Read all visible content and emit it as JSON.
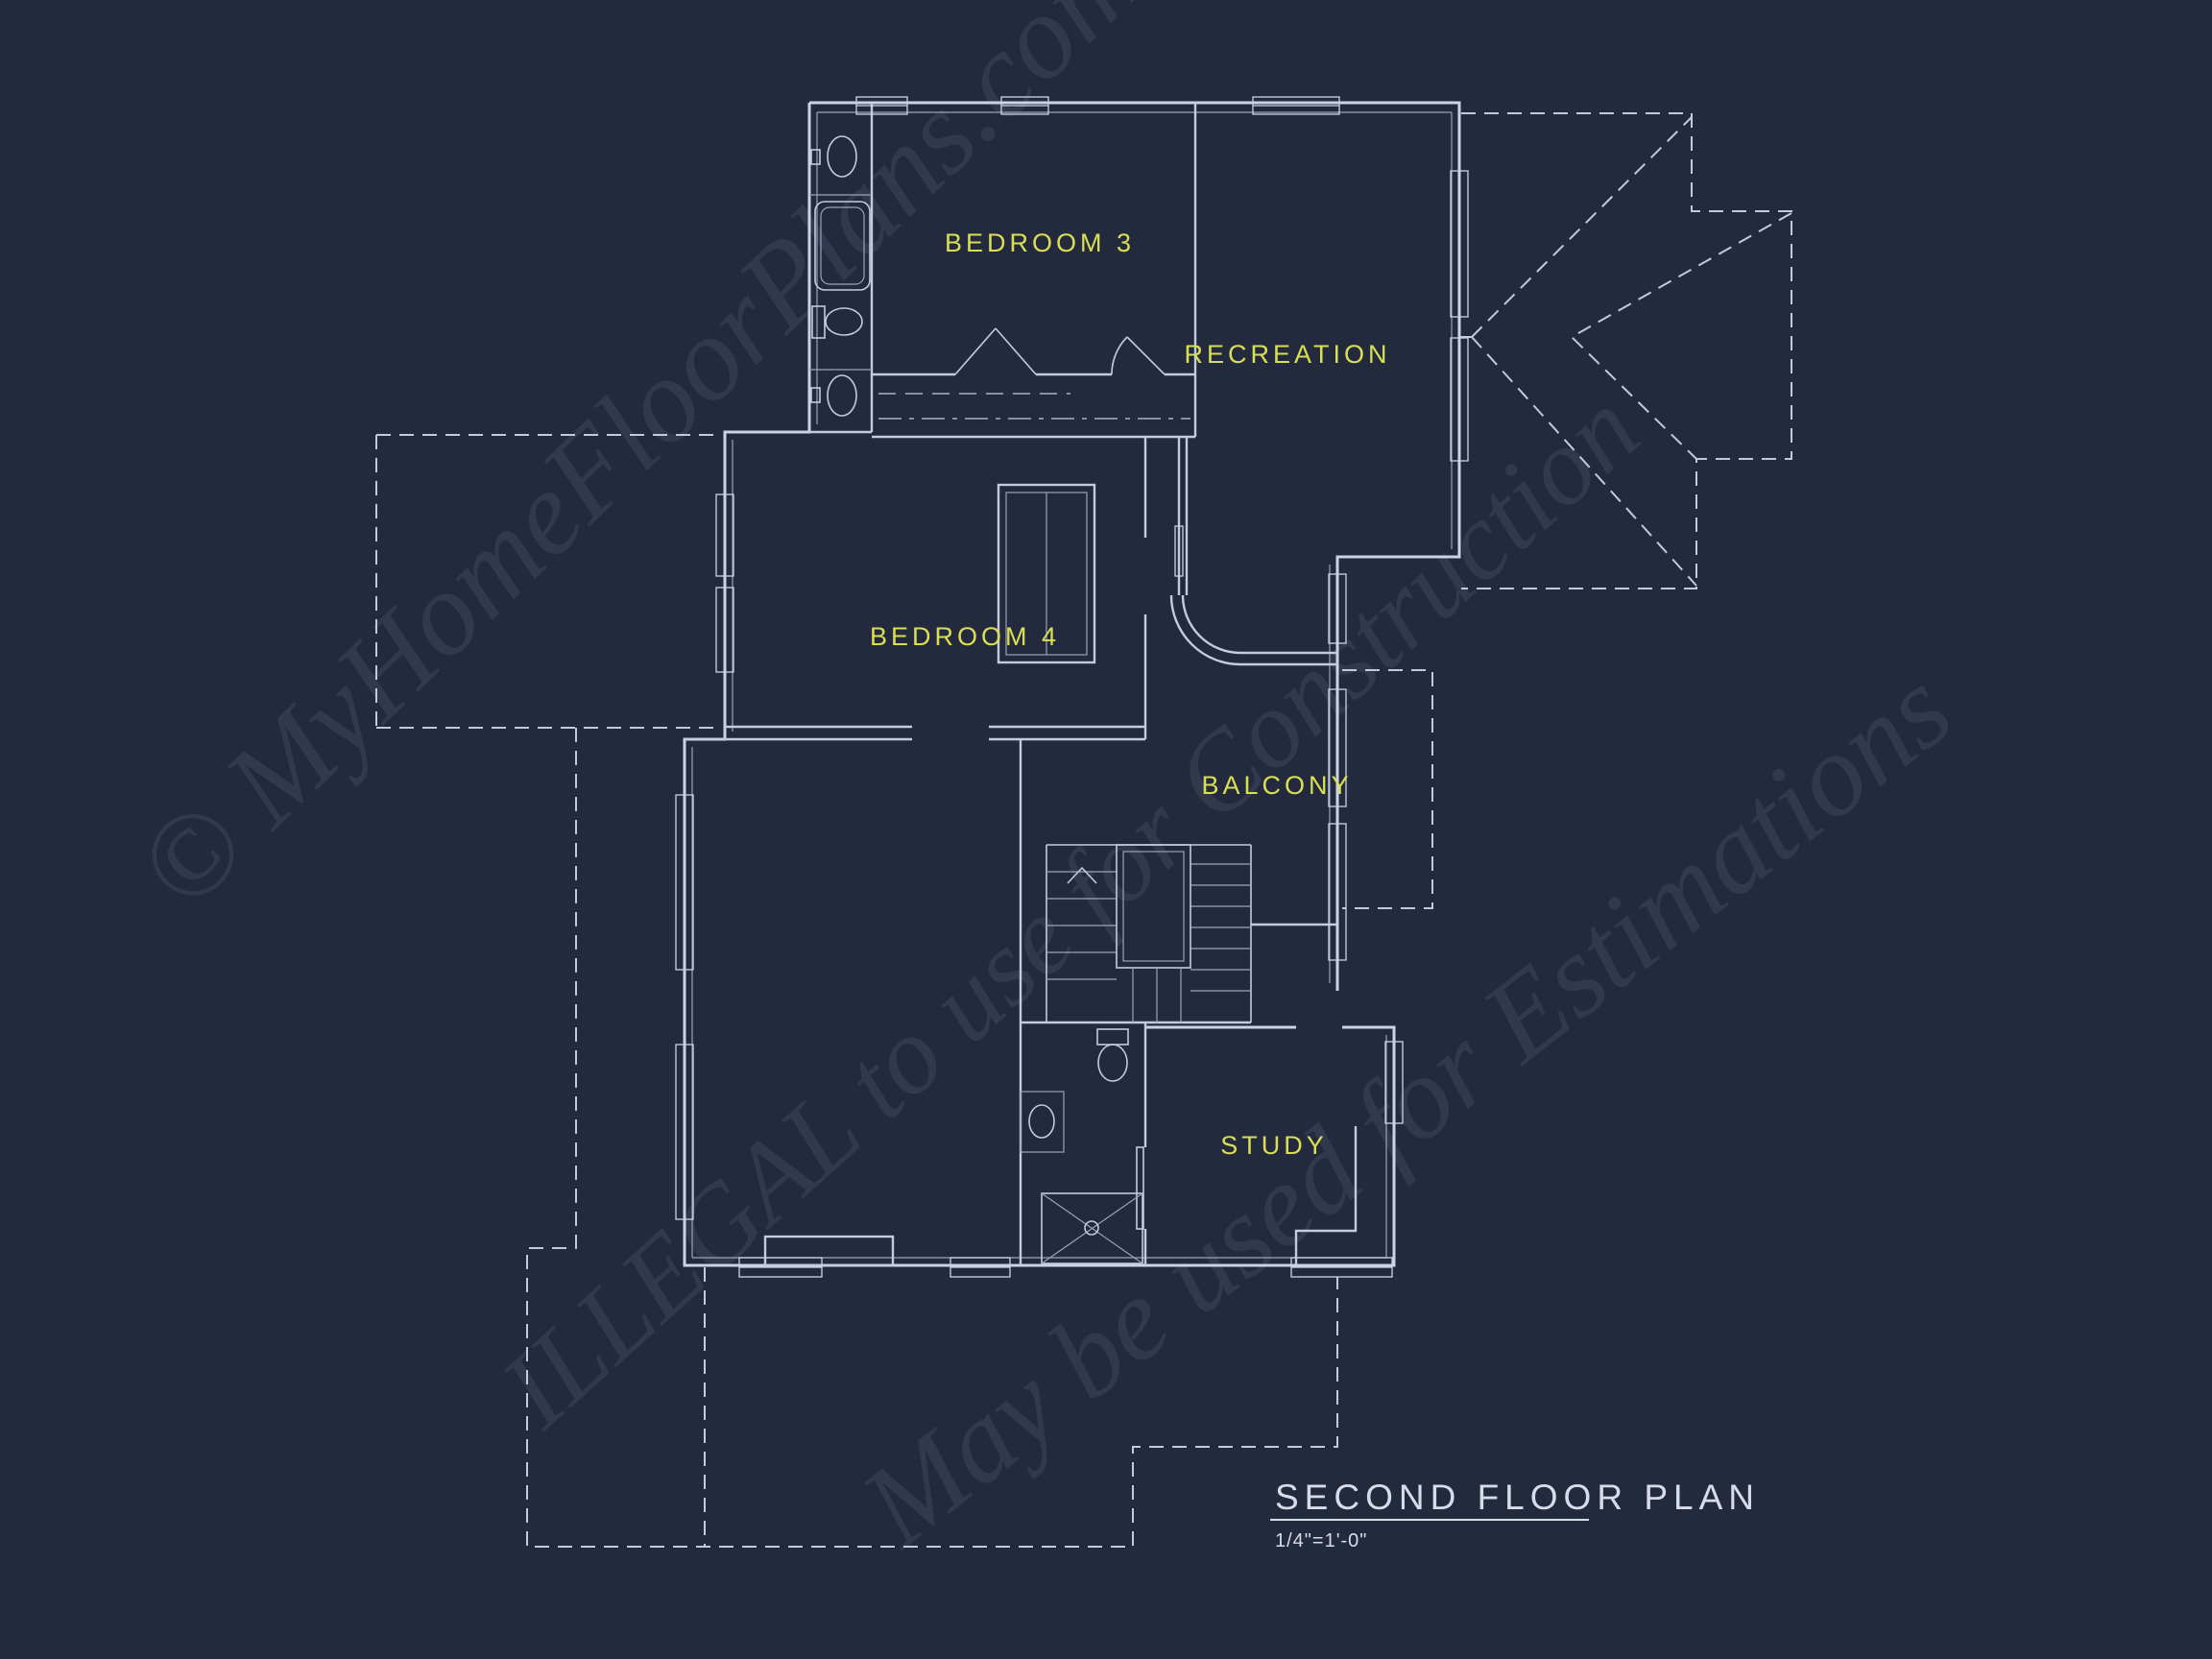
{
  "colors": {
    "background": "#242a3e",
    "wall_line": "#ccd3e6",
    "dim_line": "#9aa2bd",
    "dashed_roof_line": "#c3cade",
    "room_label": "#d9df52",
    "title_text": "#d6dcea",
    "watermark": "#cdd5f0"
  },
  "rooms": [
    {
      "id": "bedroom-3",
      "label": "BEDROOM 3"
    },
    {
      "id": "recreation",
      "label": "RECREATION"
    },
    {
      "id": "bedroom-4",
      "label": "BEDROOM 4"
    },
    {
      "id": "balcony",
      "label": "BALCONY"
    },
    {
      "id": "study",
      "label": "STUDY"
    }
  ],
  "watermark": {
    "line1": "© MyHomeFloorPlans.com",
    "line2": "ILLEGAL to use for Construction",
    "line3": "May be used for Estimations"
  },
  "title_block": {
    "title": "SECOND FLOOR PLAN",
    "scale": "1/4\"=1'-0\""
  }
}
